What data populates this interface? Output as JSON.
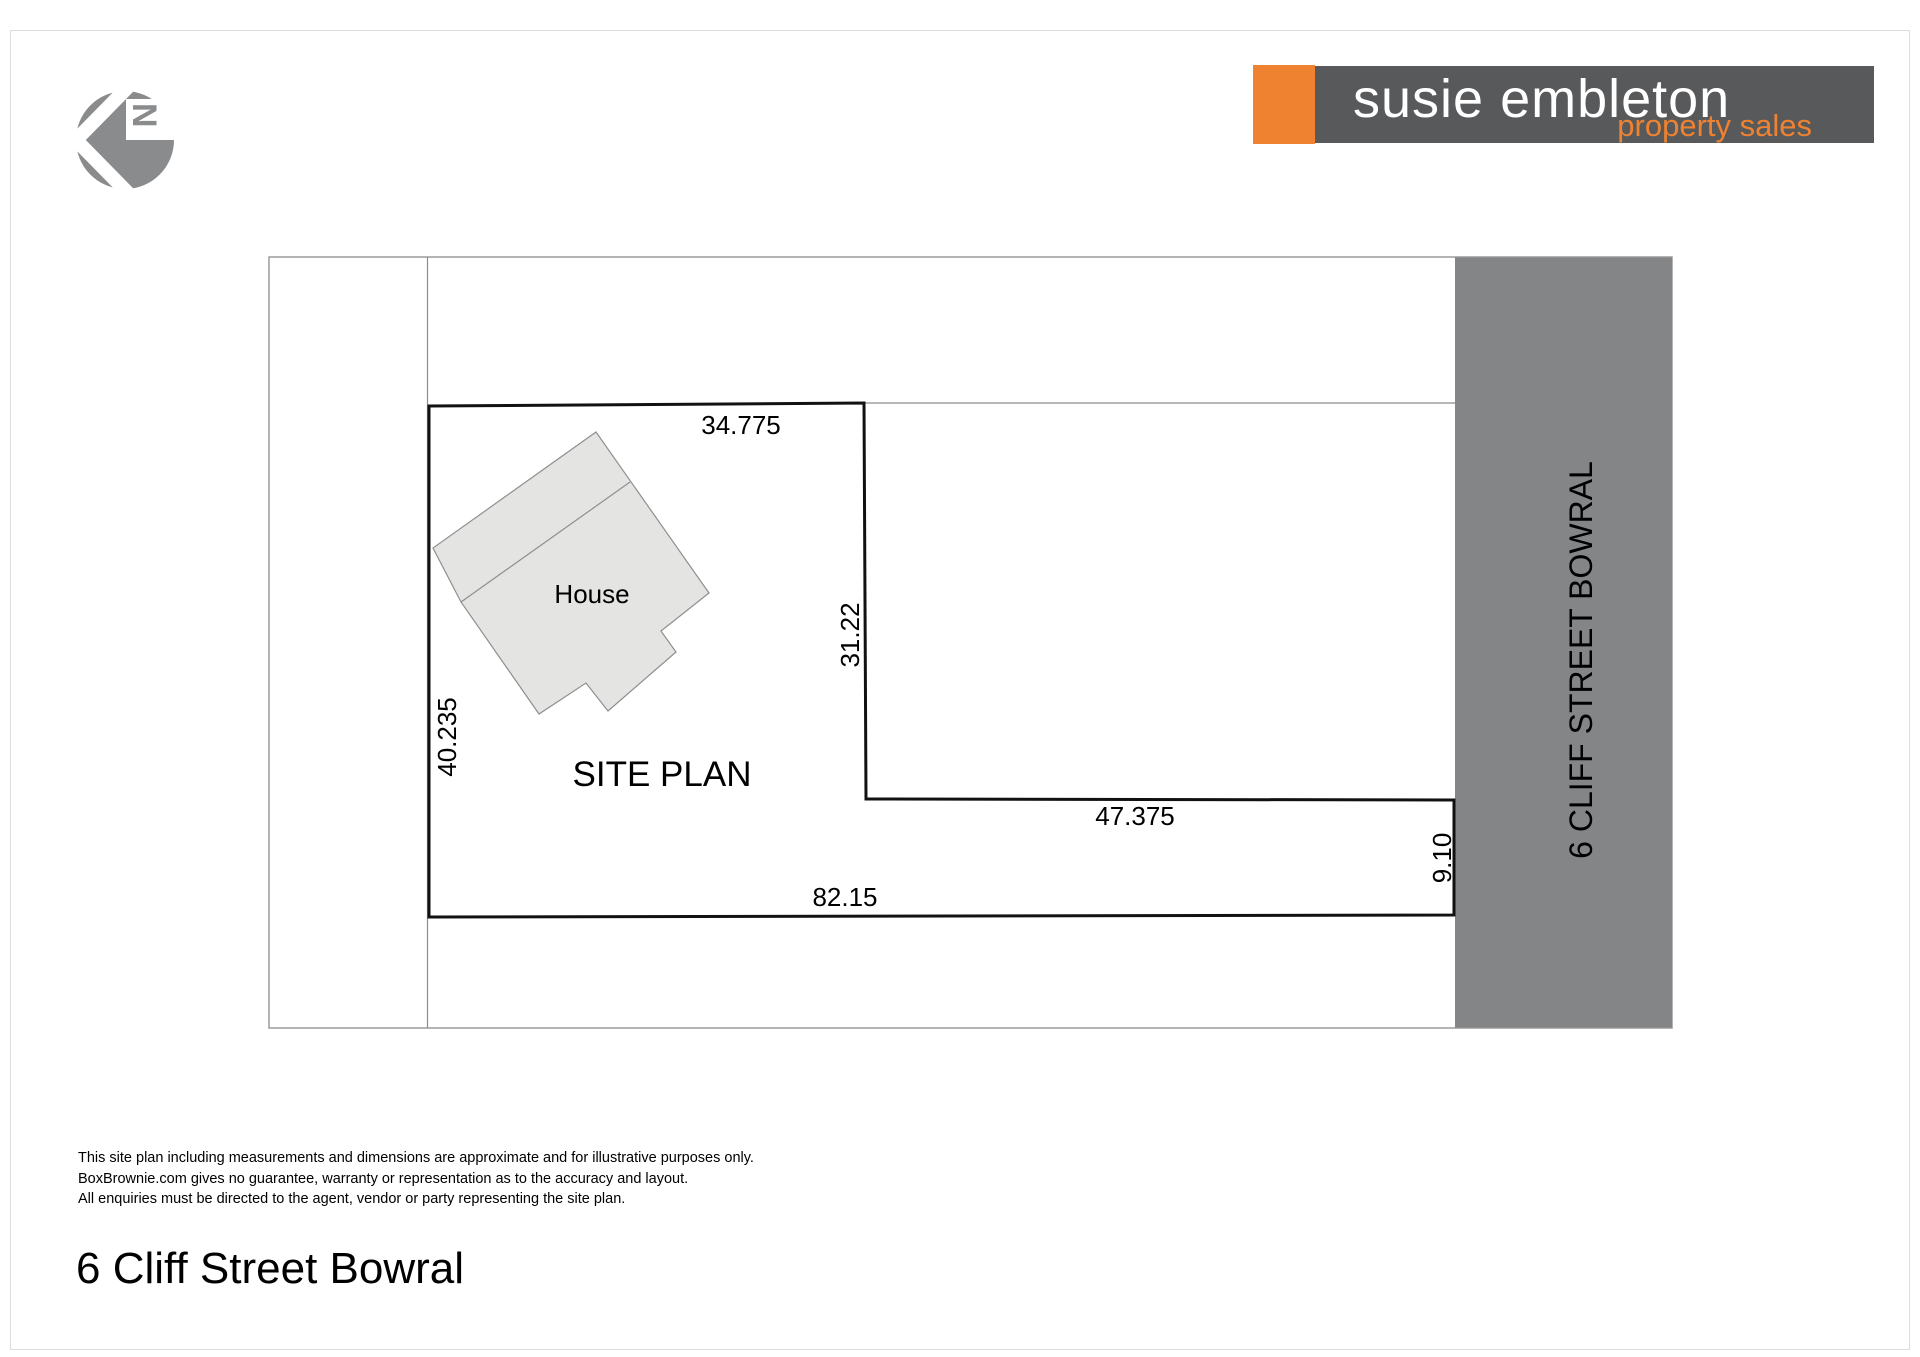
{
  "north_arrow": {
    "letter": "N"
  },
  "brand": {
    "name": "susie embleton",
    "tagline": "property sales",
    "accent_color": "#EF8230",
    "bar_color": "#58595B"
  },
  "plan": {
    "site_label": "SITE PLAN",
    "house_label": "House",
    "street_label": "6 CLIFF STREET BOWRAL",
    "street_band_color": "#848587",
    "dim_top": "34.775",
    "dim_right_upper": "31.22",
    "dim_step": "47.375",
    "dim_right_lower": "9.10",
    "dim_bottom": "82.15",
    "dim_left": "40.235"
  },
  "disclaimer": {
    "line1": "This site plan including measurements and dimensions are approximate and for illustrative purposes only.",
    "line2": "BoxBrownie.com gives no guarantee, warranty or representation as to the accuracy and layout.",
    "line3": "All enquiries must be directed to the agent, vendor or party representing the site plan."
  },
  "title": "6 Cliff Street Bowral"
}
